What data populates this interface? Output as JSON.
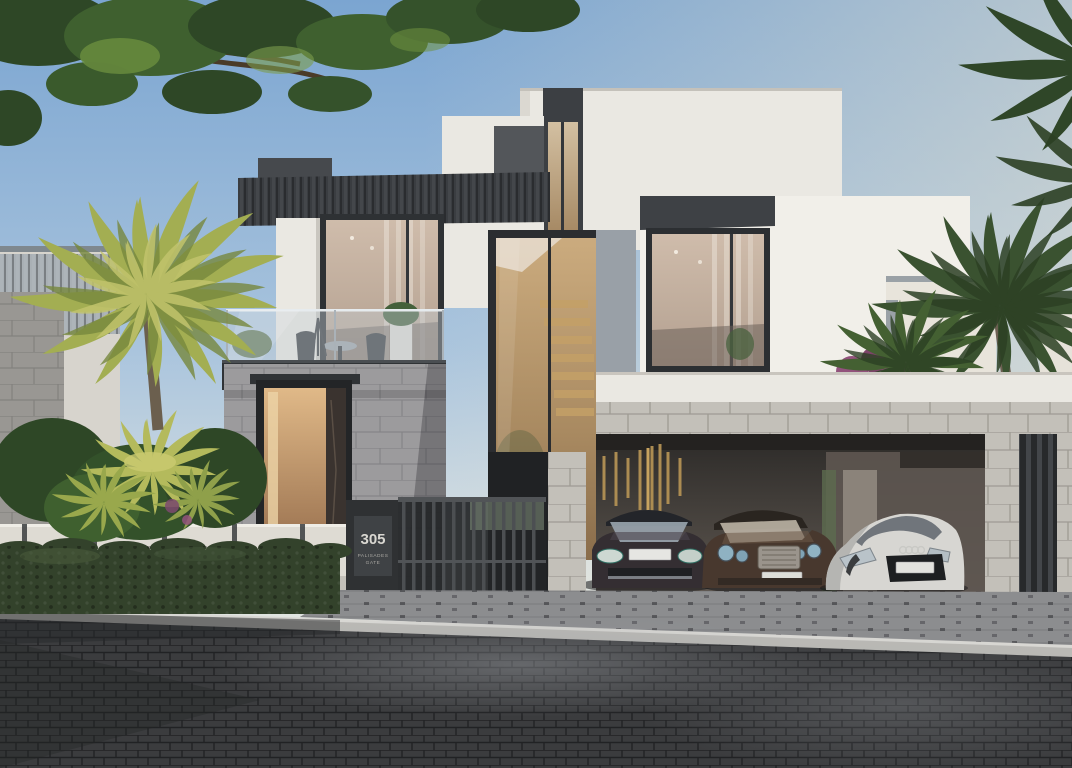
{
  "address_sign": {
    "number": "305",
    "line1": "PALISADES",
    "line2": "GATE"
  },
  "colors": {
    "sky_top": "#7BA5D1",
    "sky_mid": "#A9C4DD",
    "sky_low": "#DDE3E2",
    "sky_horizon": "#EDE7D9",
    "foliage_dark": "#2E4726",
    "foliage_mid": "#3F602F",
    "foliage_light": "#6F9140",
    "palm_yellow": "#A3AE52",
    "palm_yellow_light": "#C2C46C",
    "palm_yellow_dark": "#77883E",
    "palm_dark": "#3A5230",
    "palm_deep": "#2C4024",
    "facade_white": "#EAE8E2",
    "facade_white_bright": "#F1EFE9",
    "facade_shadow": "#D7D4CD",
    "charcoal": "#3C3F43",
    "charcoal_deep": "#26282B",
    "panel_grey_blue": "#99A0A7",
    "stone_entrance": "#9C9B9D",
    "stone_carport": "#C3C0B9",
    "carport_ceiling": "#242220",
    "glass_warm": "#C8A87A",
    "door_glow": "#D9B184",
    "balcony_glass": "#C3CDD3",
    "hedge_green": "#33422B",
    "fence_white": "#DEDBD3",
    "plaque_bg": "#3F4245",
    "plaque_text": "#D9D7D1",
    "apron_grey": "#8C8D8F",
    "curb_light": "#BAB9B5",
    "road_dark": "#3B3C3E",
    "car_porsche": "#342E32",
    "car_bentley": "#48382E",
    "car_audi": "#D7D6D2",
    "gold_decor": "#AC8C52",
    "bougainvillea": "#92527C"
  }
}
